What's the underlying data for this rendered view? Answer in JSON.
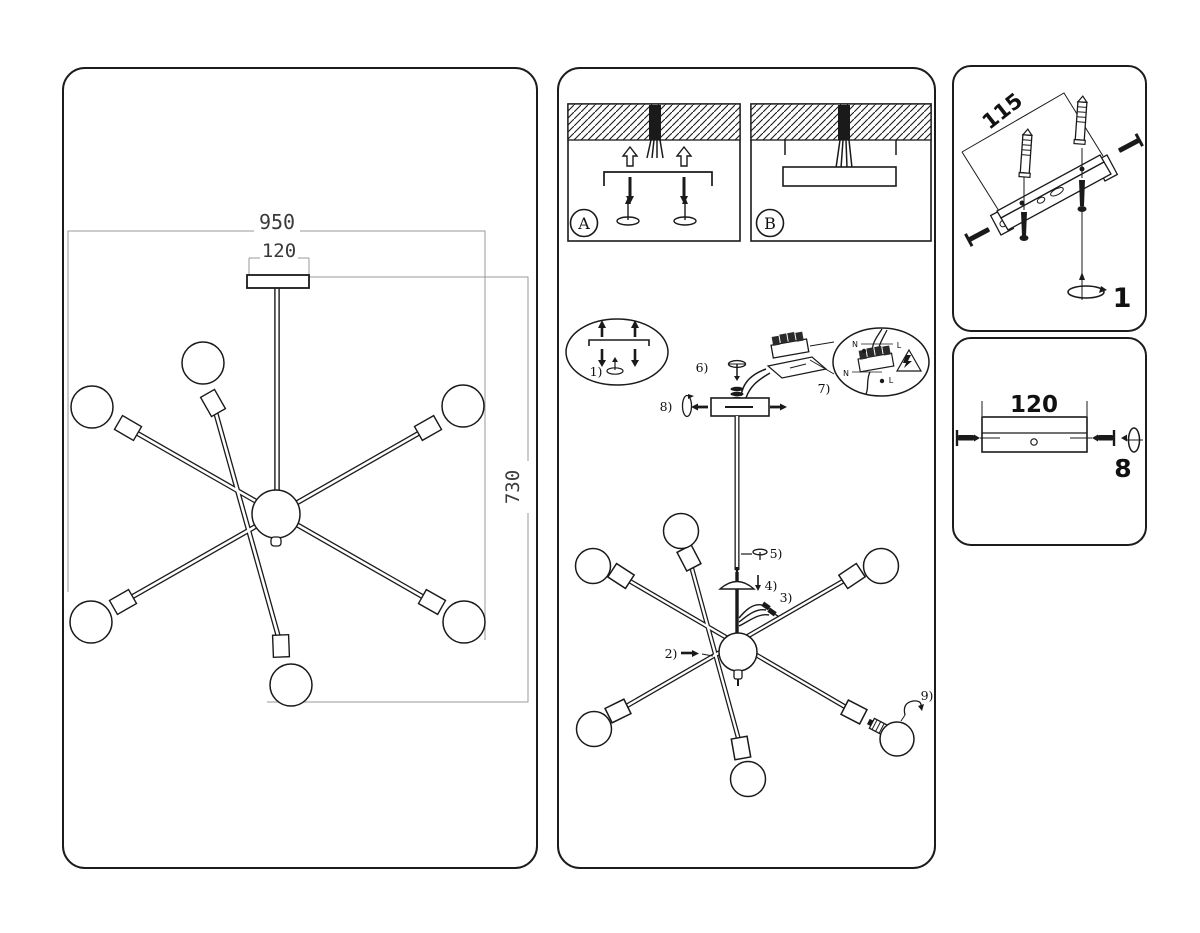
{
  "colors": {
    "ink": "#1a1a1a",
    "dim_line": "#9a9a9a",
    "paper": "#ffffff"
  },
  "overview": {
    "dim_width": "950",
    "dim_canopy": "120",
    "dim_height": "730"
  },
  "assembly": {
    "badge_a": "A",
    "badge_b": "B",
    "steps": {
      "s1": "1)",
      "s2": "2)",
      "s3": "3)",
      "s4": "4)",
      "s5": "5)",
      "s6": "6)",
      "s7": "7)",
      "s8": "8)",
      "s9": "9)"
    },
    "wiring": {
      "n1": "N",
      "l1": "L",
      "n2": "N",
      "l2": "L"
    }
  },
  "bracket_detail": {
    "dim": "115",
    "qty": "1"
  },
  "canopy_detail": {
    "dim": "120",
    "qty": "8"
  }
}
